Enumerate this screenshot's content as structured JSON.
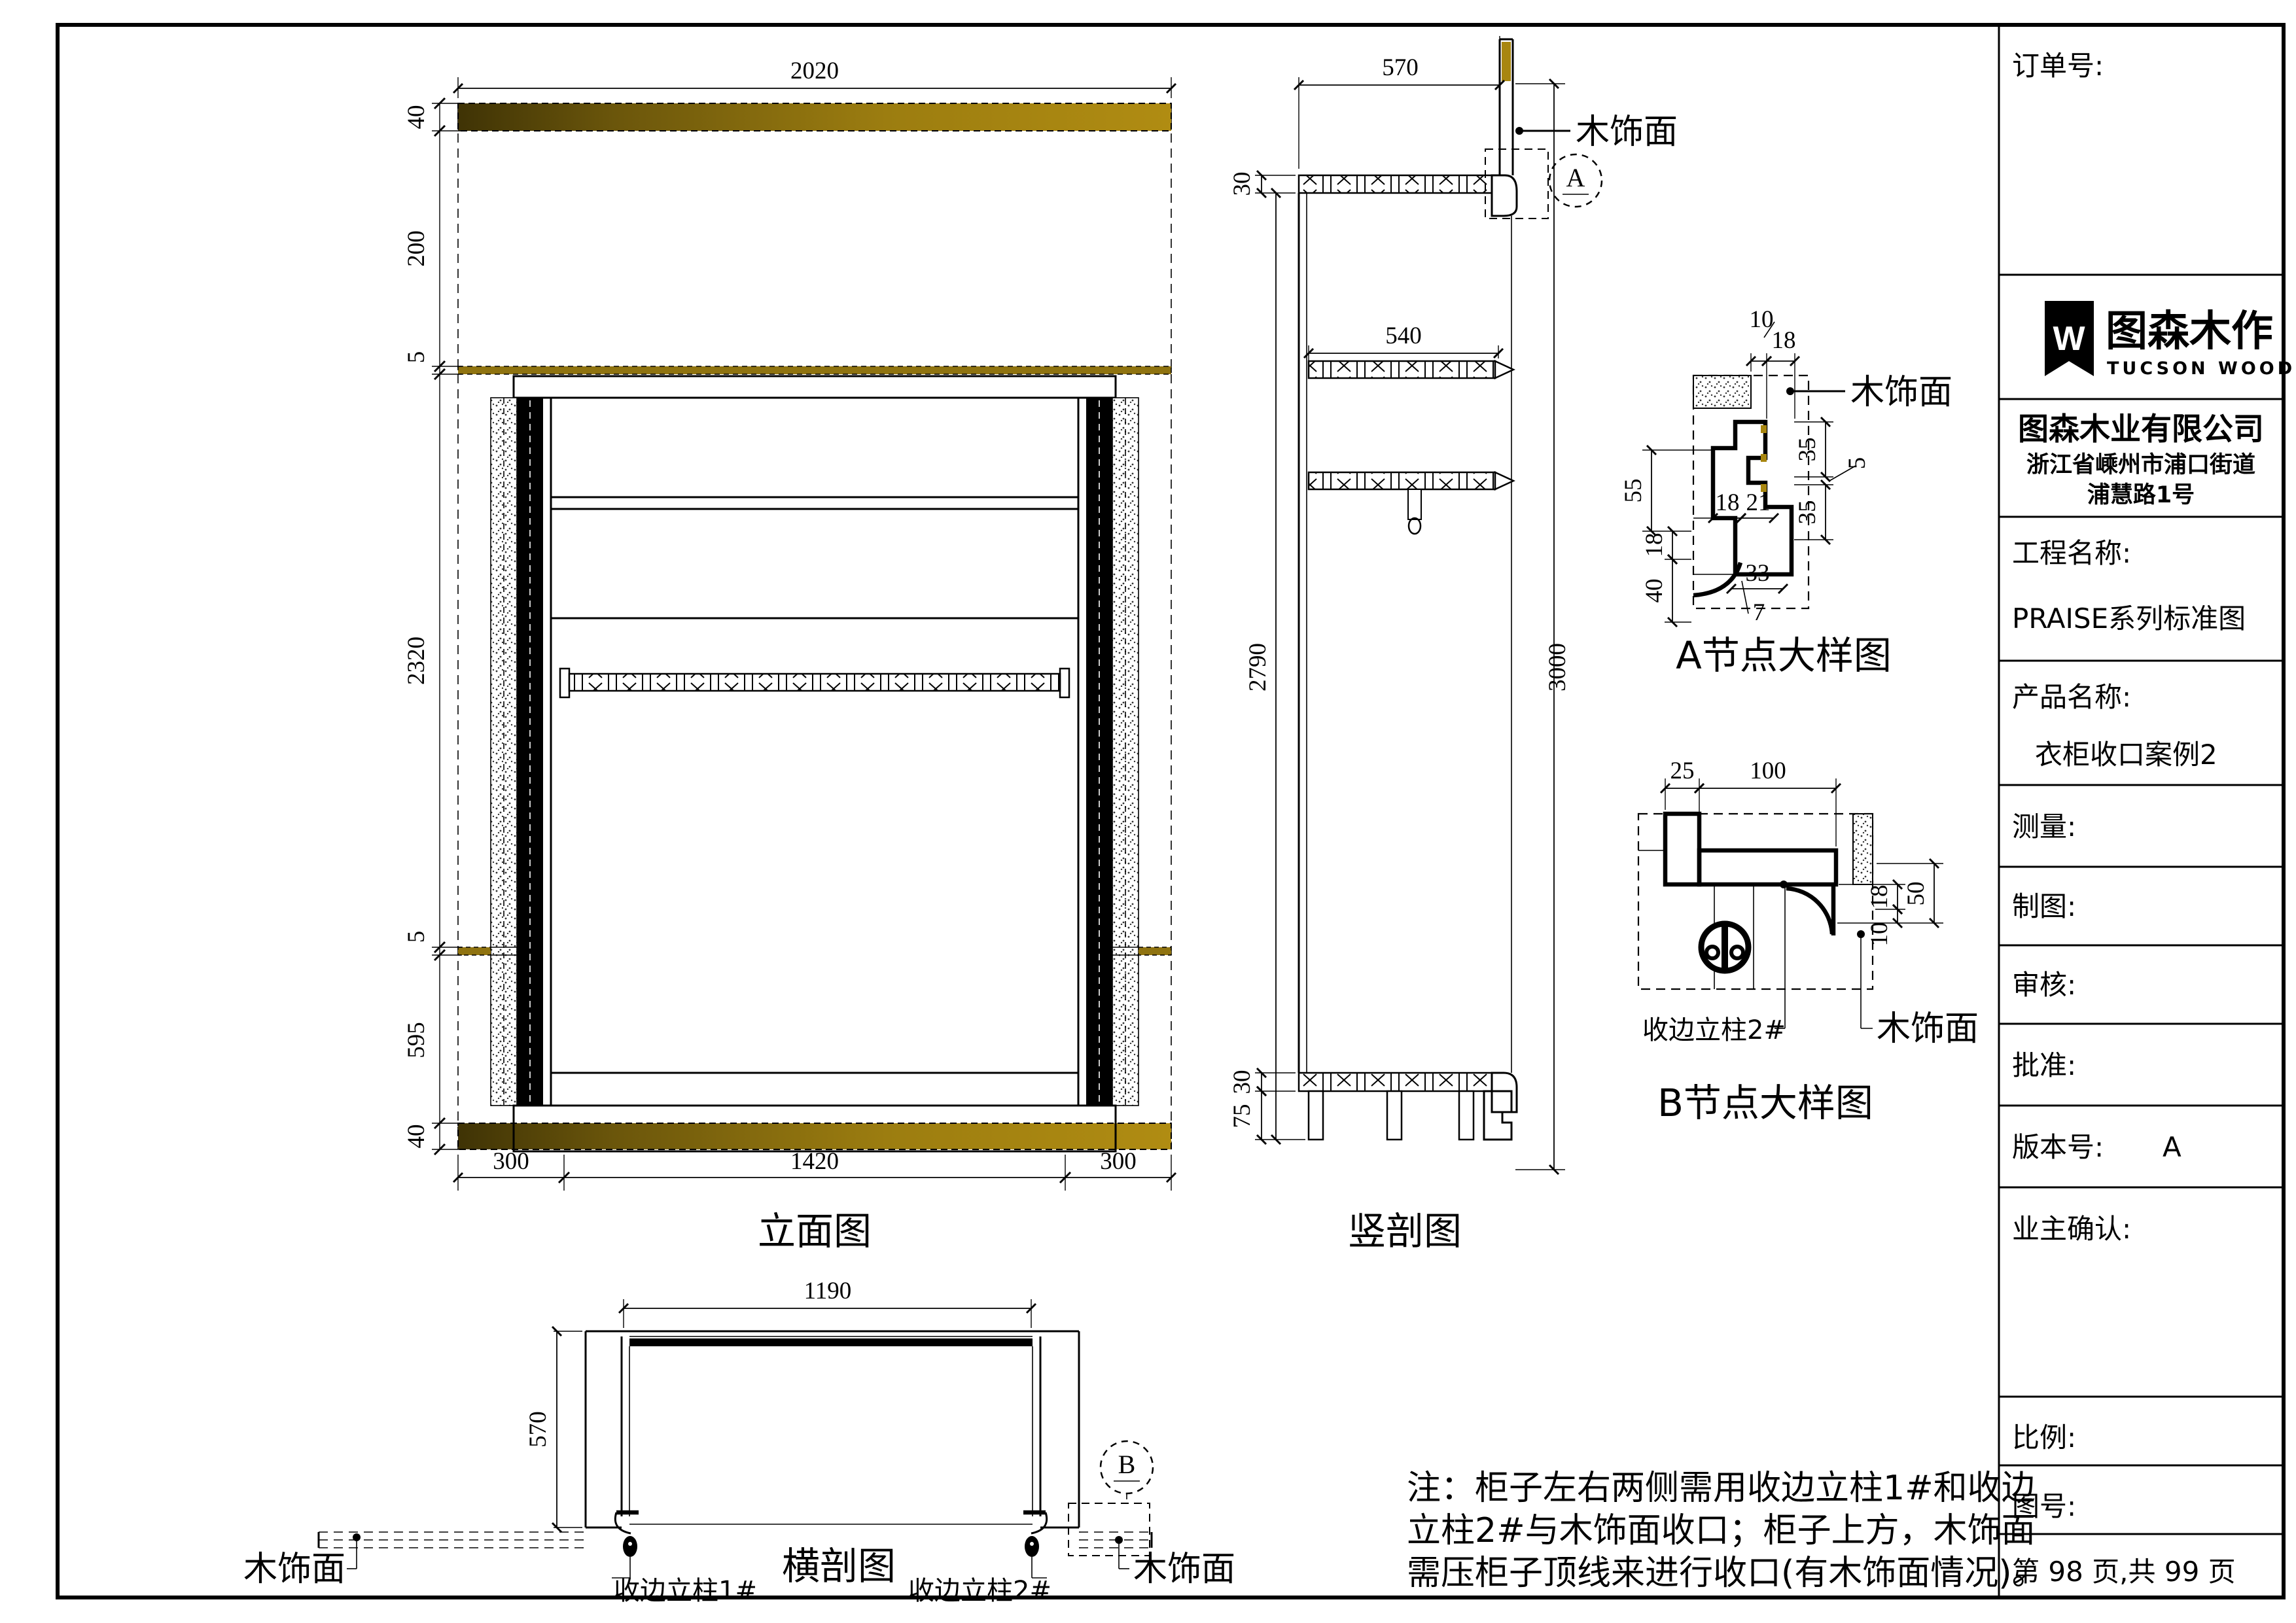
{
  "page": {
    "notes": {
      "line1": "注：柜子左右两侧需用收边立柱1#和收边",
      "line2": "立柱2#与木饰面收口；柜子上方，木饰面",
      "line3": "需压柜子顶线来进行收口(有木饰面情况)。"
    }
  },
  "title_block": {
    "order_label": "订单号:",
    "logo_letter": "W",
    "brand_cn": "图森木作",
    "brand_en": "TUCSON WOOD",
    "company": "图森木业有限公司",
    "address1": "浙江省嵊州市浦口街道",
    "address2": "浦慧路1号",
    "project_label": "工程名称:",
    "project_value": "PRAISE系列标准图",
    "product_label": "产品名称:",
    "product_value": "衣柜收口案例2",
    "measure_label": "测量:",
    "drafter_label": "制图:",
    "checker_label": "审核:",
    "approver_label": "批准:",
    "version_label": "版本号:",
    "version_value": "A",
    "owner_label": "业主确认:",
    "scale_label": "比例:",
    "figure_no_label": "图号:",
    "page_info": "第 98 页,共 99 页"
  },
  "elevation": {
    "title": "立面图",
    "dims": {
      "top": "2020",
      "l40t": "40",
      "l200": "200",
      "l5t": "5",
      "l2320": "2320",
      "l5m": "5",
      "l595": "595",
      "l40b": "40",
      "b300l": "300",
      "b1420": "1420",
      "b300r": "300"
    }
  },
  "vsection": {
    "title": "竖剖图",
    "wood_label": "木饰面",
    "bubble": "A",
    "dims": {
      "depth": "570",
      "top_panel": "30",
      "shelf": "540",
      "inner": "2790",
      "total": "3000",
      "bottom_panel": "30",
      "plinth": "75"
    }
  },
  "detail_a": {
    "title": "A节点大样图",
    "wood_label": "木饰面",
    "dims": {
      "d10": "10",
      "d18top": "18",
      "d55": "55",
      "d18l": "18",
      "d40": "40",
      "d18i": "18",
      "d21": "21",
      "d33": "33",
      "d7": "7",
      "d35t": "35",
      "d5": "5",
      "d35b": "35"
    }
  },
  "detail_b": {
    "title": "B节点大样图",
    "post_label": "收边立柱2#",
    "wood_label": "木饰面",
    "dims": {
      "d25": "25",
      "d100": "100",
      "d18": "18",
      "d10": "10",
      "d50": "50"
    }
  },
  "hsection": {
    "title": "横剖图",
    "bubble": "B",
    "wood_left": "木饰面",
    "wood_right": "木饰面",
    "post1": "收边立柱1#",
    "post2": "收边立柱2#",
    "dims": {
      "width": "1190",
      "depth": "570"
    }
  }
}
